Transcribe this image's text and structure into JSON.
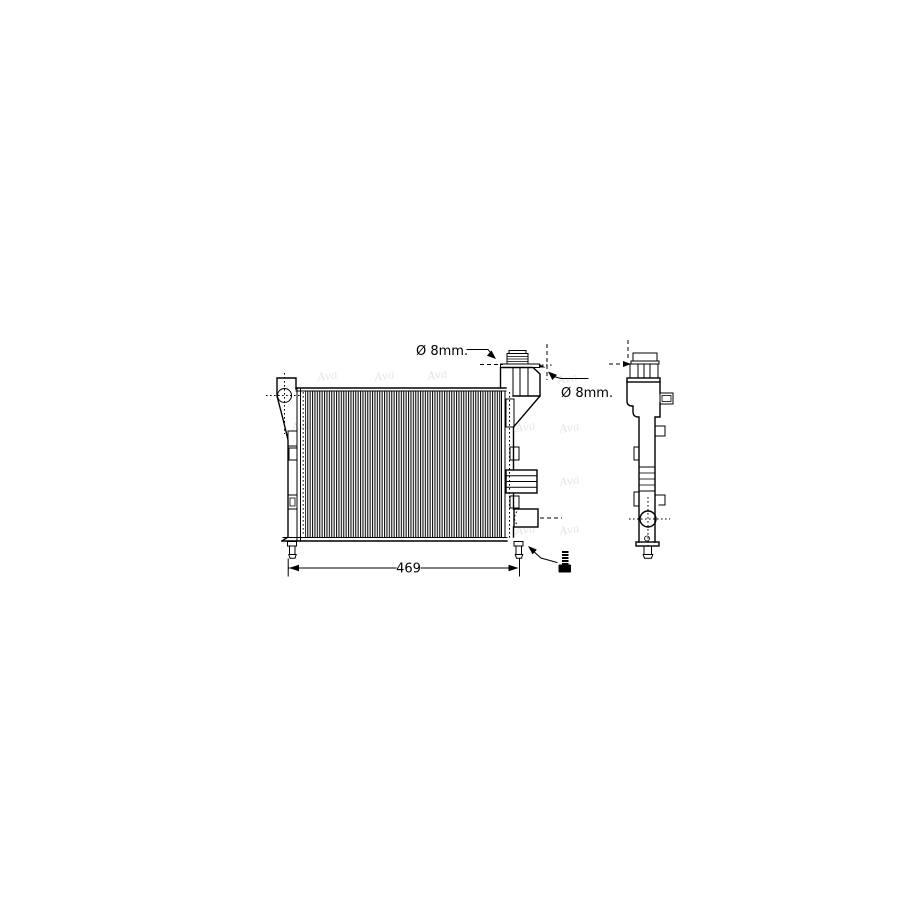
{
  "drawing": {
    "subject": "radiator-technical-drawing",
    "views": {
      "front": "front-view",
      "side": "side-view"
    },
    "colors": {
      "line": "#000000",
      "background": "#ffffff",
      "watermark": "#8a8a8a"
    },
    "annotations": {
      "top_diameter": "Ø 8mm.",
      "side_diameter": "Ø 8mm.",
      "width_dimension": "469"
    },
    "icons": {
      "mounting": "screw-icon"
    },
    "watermark": {
      "text": "Ava"
    }
  }
}
